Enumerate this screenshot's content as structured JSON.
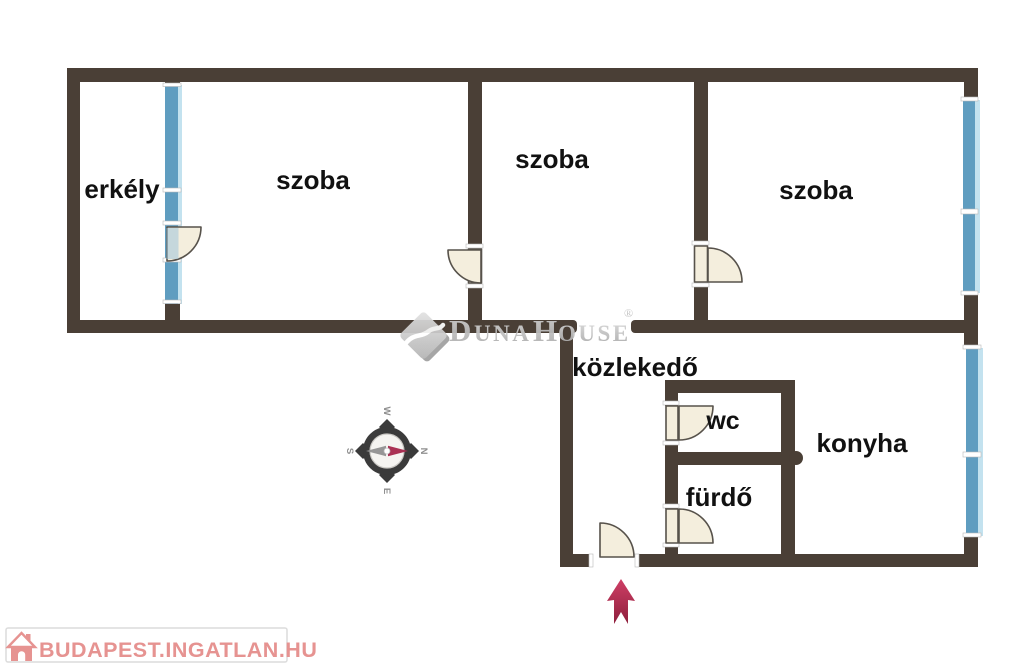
{
  "rooms": [
    {
      "name": "erkely",
      "label": "erkély"
    },
    {
      "name": "szoba-left",
      "label": "szoba"
    },
    {
      "name": "szoba-middle",
      "label": "szoba"
    },
    {
      "name": "szoba-right",
      "label": "szoba"
    },
    {
      "name": "kozlekedo",
      "label": "közlekedő"
    },
    {
      "name": "wc",
      "label": "wc"
    },
    {
      "name": "furdo",
      "label": "fürdő"
    },
    {
      "name": "konyha",
      "label": "konyha"
    }
  ],
  "compass": {
    "north": "N",
    "east": "E",
    "south": "S",
    "west": "W"
  },
  "watermark": {
    "d": "D",
    "una": "UNA",
    "h": "H",
    "ouse": "OUSE",
    "reg": "®"
  },
  "footer": {
    "label": "BUDAPEST.INGATLAN.HU"
  },
  "colors": {
    "wall": "#4a3f36",
    "window_blue": "#5f9dc0",
    "window_light": "#c3e2ef",
    "window_tint": "#9ec4da",
    "door_fill": "#f4eedd",
    "door_stroke": "#57524b",
    "tick_white": "#ffffff",
    "label": "#111111",
    "arrow_top": "#cf3f66",
    "arrow_bottom": "#8e1f3c",
    "compass_dark": "#3b3b3b",
    "compass_gray": "#969696",
    "compass_red": "#aa3154",
    "compass_label": "#8f8f8f",
    "compass_face": "#f5f4f1",
    "watermark_light": "#d8d8d8",
    "watermark_dark": "#a8a8a8",
    "logo_pink": "#e69391"
  }
}
